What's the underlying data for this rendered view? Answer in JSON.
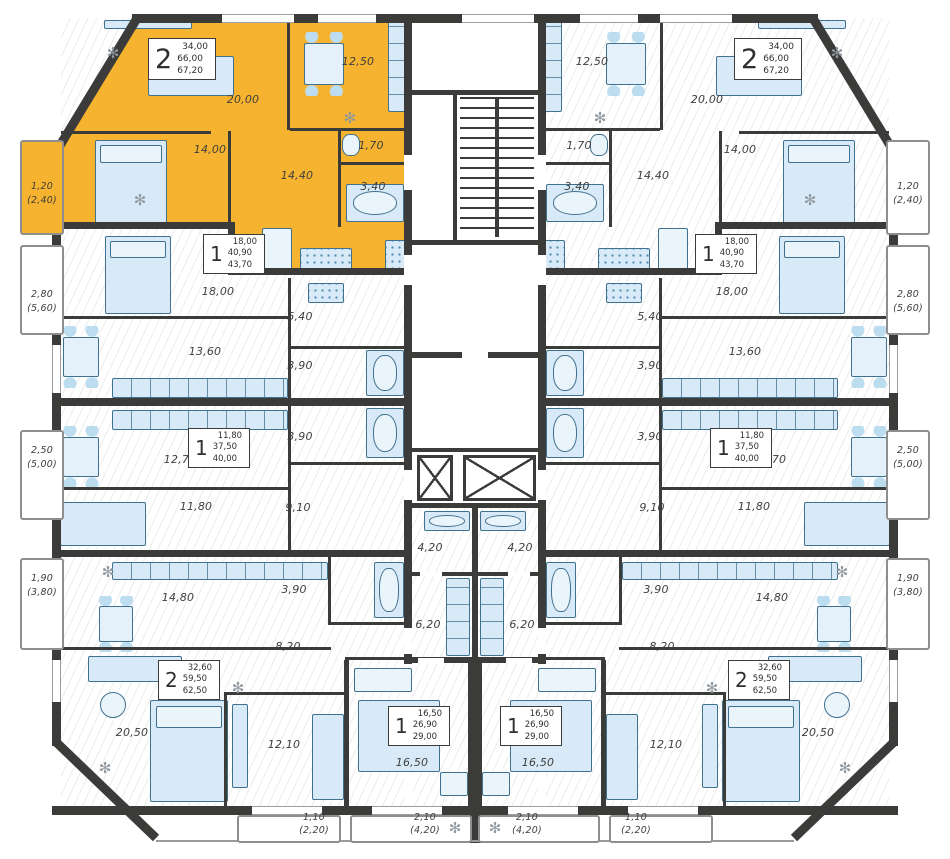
{
  "colors": {
    "highlight": "#F6B32F",
    "wall": "#3B3B3A",
    "fixture_fill": "#D8EAF7",
    "fixture_stroke": "#40718F",
    "label": "#3E3E3D"
  },
  "icons": {
    "plant": "✻"
  },
  "apartments": {
    "a2_top": {
      "rooms_count": "2",
      "stats": [
        "34,00",
        "66,00",
        "67,20"
      ],
      "highlighted": true,
      "rooms": {
        "living": "20,00",
        "kitchen": "12,50",
        "bedroom": "14,00",
        "hall": "14,40",
        "wc": "1,70",
        "bath": "3,40",
        "balcony": "1,20",
        "balcony_total": "(2,40)"
      }
    },
    "a1_mid": {
      "rooms_count": "1",
      "stats": [
        "18,00",
        "40,90",
        "43,70"
      ],
      "rooms": {
        "bedroom": "18,00",
        "kitchen": "13,60",
        "hall": "5,40",
        "bath": "3,90",
        "balcony": "2,80",
        "balcony_total": "(5,60)"
      }
    },
    "a1_low": {
      "rooms_count": "1",
      "stats": [
        "11,80",
        "37,50",
        "40,00"
      ],
      "rooms": {
        "kitchen": "12,70",
        "room": "11,80",
        "hall": "9,10",
        "bath": "3,90",
        "balcony": "2,50",
        "balcony_total": "(5,00)"
      }
    },
    "a2_bot": {
      "rooms_count": "2",
      "stats": [
        "32,60",
        "59,50",
        "62,50"
      ],
      "rooms": {
        "kitchen": "14,80",
        "living": "20,50",
        "bedroom": "12,10",
        "hall": "8,20",
        "bath": "3,90",
        "balcony": "1,90",
        "balcony_total": "(3,80)",
        "balcony2": "1,10",
        "balcony2_total": "(2,20)"
      }
    },
    "studio": {
      "rooms_count": "1",
      "stats": [
        "16,50",
        "26,90",
        "29,00"
      ],
      "rooms": {
        "room": "16,50",
        "kitchen": "6,20",
        "bath": "4,20",
        "balcony": "2,10",
        "balcony_total": "(4,20)"
      }
    }
  }
}
